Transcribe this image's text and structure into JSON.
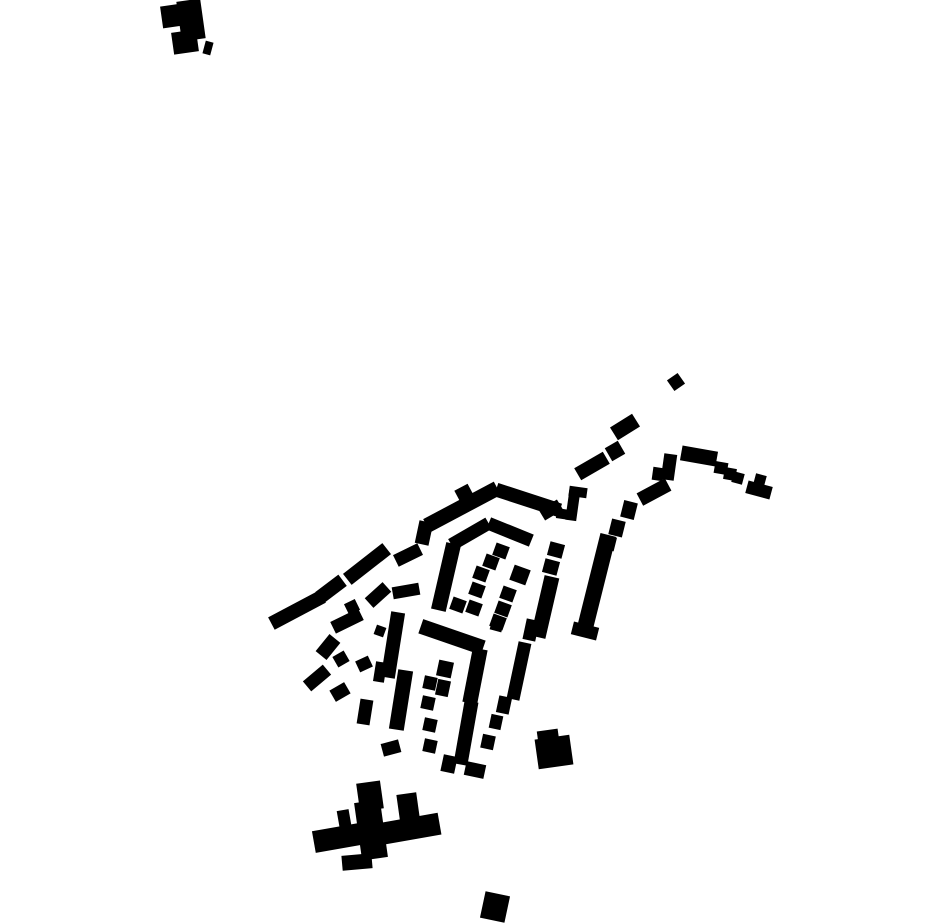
{
  "canvas": {
    "width": 930,
    "height": 924,
    "background_color": "#ffffff"
  },
  "map_data": {
    "type": "figure-ground-building-footprint-map",
    "description": "black building footprints of a small settlement on a white ground",
    "building_color": "#000000",
    "buildings": [
      [
        191,
        20,
        24,
        40,
        -8
      ],
      [
        172,
        16,
        21,
        22,
        -8
      ],
      [
        185,
        42,
        25,
        22,
        -8
      ],
      [
        208,
        48,
        8,
        13,
        15
      ],
      [
        462,
        507,
        80,
        15,
        -28
      ],
      [
        464,
        493,
        15,
        13,
        -28
      ],
      [
        528,
        500,
        67,
        14,
        18
      ],
      [
        573,
        504,
        11,
        33,
        8
      ],
      [
        578,
        492,
        18,
        10,
        8
      ],
      [
        563,
        514,
        13,
        10,
        8
      ],
      [
        551,
        510,
        21,
        12,
        -31
      ],
      [
        470,
        534,
        43,
        13,
        -30
      ],
      [
        510,
        532,
        46,
        13,
        22
      ],
      [
        424,
        533,
        14,
        23,
        12
      ],
      [
        408,
        555,
        27,
        13,
        -26
      ],
      [
        367,
        564,
        50,
        14,
        -38
      ],
      [
        331,
        589,
        29,
        14,
        -37
      ],
      [
        297,
        610,
        58,
        14,
        -28
      ],
      [
        378,
        595,
        24,
        13,
        -42
      ],
      [
        347,
        621,
        31,
        13,
        -26
      ],
      [
        352,
        607,
        12,
        12,
        -26
      ],
      [
        380,
        631,
        10,
        10,
        20
      ],
      [
        328,
        647,
        22,
        14,
        -51
      ],
      [
        341,
        659,
        13,
        12,
        -30
      ],
      [
        364,
        664,
        14,
        12,
        -25
      ],
      [
        317,
        678,
        26,
        13,
        -40
      ],
      [
        340,
        692,
        17,
        13,
        -30
      ],
      [
        406,
        591,
        27,
        12,
        -10
      ],
      [
        393,
        645,
        14,
        66,
        9
      ],
      [
        380,
        672,
        11,
        20,
        9
      ],
      [
        401,
        700,
        15,
        60,
        9
      ],
      [
        365,
        712,
        13,
        25,
        9
      ],
      [
        391,
        748,
        18,
        13,
        -15
      ],
      [
        446,
        577,
        15,
        68,
        13
      ],
      [
        501,
        551,
        14,
        13,
        20
      ],
      [
        491,
        562,
        14,
        13,
        20
      ],
      [
        481,
        574,
        14,
        13,
        20
      ],
      [
        520,
        575,
        17,
        16,
        20
      ],
      [
        477,
        590,
        14,
        13,
        20
      ],
      [
        508,
        594,
        14,
        13,
        20
      ],
      [
        458,
        605,
        14,
        13,
        20
      ],
      [
        474,
        608,
        14,
        13,
        20
      ],
      [
        503,
        609,
        14,
        13,
        20
      ],
      [
        498,
        622,
        14,
        13,
        20
      ],
      [
        556,
        550,
        15,
        14,
        15
      ],
      [
        551,
        567,
        15,
        14,
        15
      ],
      [
        545,
        607,
        15,
        62,
        13
      ],
      [
        597,
        580,
        16,
        93,
        14
      ],
      [
        585,
        631,
        26,
        13,
        14
      ],
      [
        629,
        510,
        14,
        17,
        14
      ],
      [
        617,
        528,
        14,
        16,
        14
      ],
      [
        609,
        543,
        13,
        14,
        14
      ],
      [
        592,
        466,
        33,
        14,
        -30
      ],
      [
        615,
        451,
        15,
        15,
        -30
      ],
      [
        625,
        427,
        26,
        15,
        -32
      ],
      [
        676,
        382,
        13,
        13,
        -35
      ],
      [
        669,
        467,
        13,
        26,
        8
      ],
      [
        658,
        474,
        11,
        13,
        8
      ],
      [
        699,
        456,
        36,
        15,
        10
      ],
      [
        721,
        468,
        13,
        12,
        10
      ],
      [
        730,
        474,
        12,
        12,
        10
      ],
      [
        738,
        478,
        11,
        11,
        15
      ],
      [
        759,
        490,
        25,
        13,
        15
      ],
      [
        760,
        480,
        11,
        11,
        15
      ],
      [
        654,
        492,
        32,
        14,
        -28
      ],
      [
        452,
        637,
        66,
        15,
        19
      ],
      [
        475,
        676,
        15,
        55,
        11
      ],
      [
        466,
        733,
        14,
        64,
        10
      ],
      [
        497,
        625,
        12,
        12,
        15
      ],
      [
        531,
        630,
        13,
        21,
        12
      ],
      [
        519,
        671,
        13,
        58,
        12
      ],
      [
        504,
        705,
        13,
        17,
        12
      ],
      [
        445,
        669,
        15,
        16,
        12
      ],
      [
        443,
        688,
        13,
        16,
        12
      ],
      [
        430,
        683,
        13,
        13,
        12
      ],
      [
        428,
        703,
        13,
        13,
        12
      ],
      [
        430,
        725,
        13,
        13,
        12
      ],
      [
        430,
        746,
        13,
        13,
        12
      ],
      [
        496,
        722,
        12,
        14,
        12
      ],
      [
        488,
        742,
        13,
        14,
        12
      ],
      [
        475,
        770,
        20,
        14,
        12
      ],
      [
        449,
        764,
        14,
        17,
        12
      ],
      [
        554,
        752,
        35,
        30,
        -8
      ],
      [
        548,
        736,
        21,
        12,
        -8
      ],
      [
        370,
        796,
        24,
        28,
        -8
      ],
      [
        408,
        806,
        20,
        25,
        -8
      ],
      [
        409,
        829,
        62,
        22,
        -10
      ],
      [
        337,
        838,
        47,
        22,
        -10
      ],
      [
        344,
        818,
        12,
        16,
        -10
      ],
      [
        357,
        862,
        30,
        15,
        -5
      ],
      [
        371,
        830,
        26,
        58,
        -8
      ],
      [
        495,
        907,
        25,
        27,
        12
      ]
    ]
  }
}
